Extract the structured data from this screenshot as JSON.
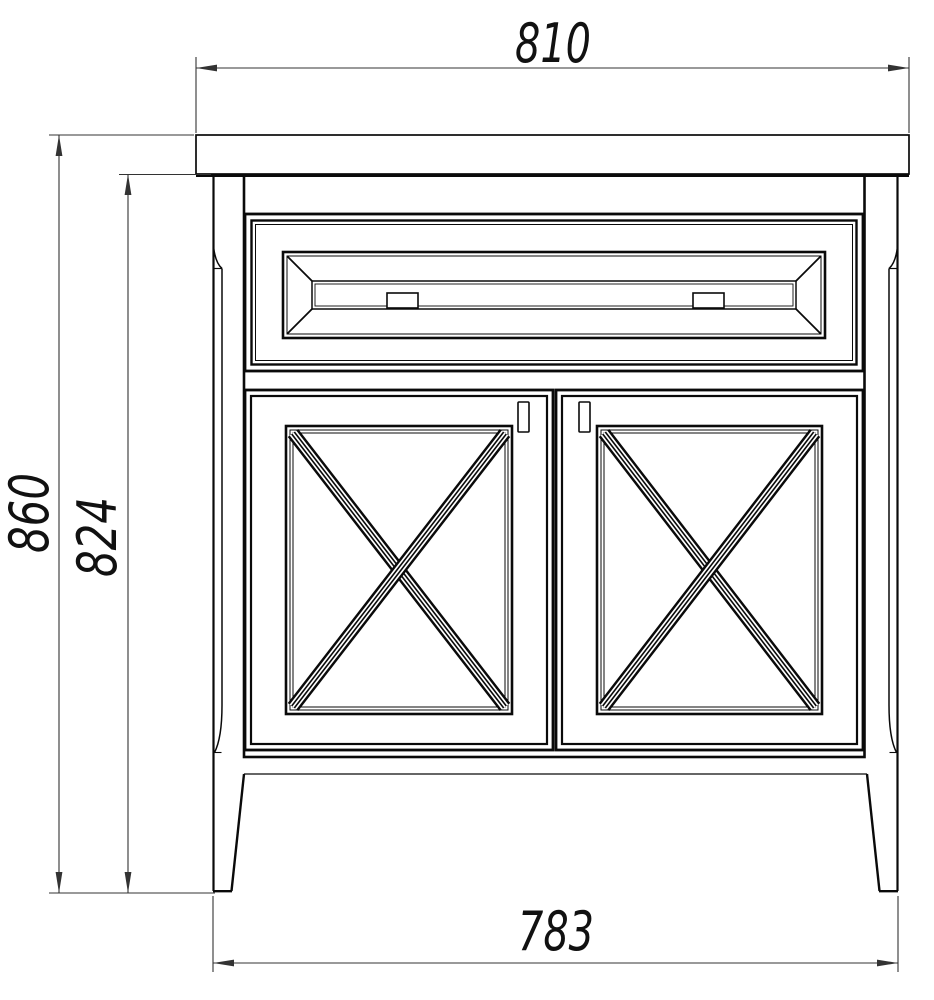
{
  "drawing": {
    "kind": "furniture-front-elevation",
    "subject": "two-door vanity cabinet with top drawer, crossed (X) door panels and tapered legs",
    "dimensions": {
      "top_width": "810",
      "overall_height": "860",
      "body_height": "824",
      "bottom_width": "783"
    },
    "colors": {
      "line": "#0a0a0a",
      "dimension": "#333333",
      "background": "#ffffff"
    }
  }
}
